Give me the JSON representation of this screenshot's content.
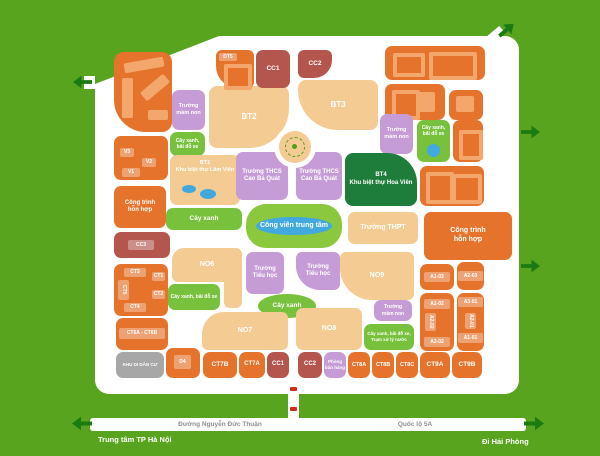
{
  "map": {
    "colors": {
      "background": "#58a41e",
      "road": "#ffffff",
      "residential": "#e5732b",
      "building": "#f3a76d",
      "villa_tan": "#f4cb92",
      "public": "#b4564e",
      "school": "#c59cd6",
      "green": "#77c13c",
      "park": "#8cc83e",
      "villa_green": "#1e7d3a",
      "gray": "#a7a7a7",
      "water": "#41a9de",
      "arrow": "#1c7a12",
      "road_text": "#8f8f8f"
    },
    "roads": {
      "west": "Đường Nguyễn Đức Thuận",
      "east": "Quốc lộ 5A"
    },
    "destinations": {
      "west": "Trung tâm TP Hà Nội",
      "east": "Đi Hải Phòng"
    },
    "blocks": [
      {
        "id": "residential-nw",
        "type": "res",
        "x": 114,
        "y": 52,
        "w": 58,
        "h": 80,
        "r": "10px 10px 10px 32px",
        "buildings": [
          {
            "x": 10,
            "y": 8,
            "w": 40,
            "h": 10,
            "rot": -10
          },
          {
            "x": 8,
            "y": 26,
            "w": 11,
            "h": 40
          },
          {
            "x": 26,
            "y": 30,
            "w": 30,
            "h": 11,
            "rot": -40
          },
          {
            "x": 34,
            "y": 58,
            "w": 20,
            "h": 10
          }
        ]
      },
      {
        "id": "residential-nw-v",
        "type": "res",
        "x": 114,
        "y": 136,
        "w": 54,
        "h": 44,
        "tags": [
          {
            "t": "V3",
            "x": 6,
            "y": 12,
            "w": 14,
            "h": 9
          },
          {
            "t": "V2",
            "x": 28,
            "y": 22,
            "w": 14,
            "h": 9
          },
          {
            "t": "V1",
            "x": 8,
            "y": 32,
            "w": 18,
            "h": 9
          }
        ]
      },
      {
        "id": "mixed-use-west",
        "type": "res",
        "x": 114,
        "y": 186,
        "w": 52,
        "h": 42,
        "label": "Công trình\nhỗn hợp",
        "fs": 6
      },
      {
        "id": "cc3",
        "type": "cc",
        "x": 114,
        "y": 232,
        "w": 56,
        "h": 26,
        "tags": [
          {
            "t": "CC3",
            "x": 14,
            "y": 8,
            "w": 26,
            "h": 10
          }
        ]
      },
      {
        "id": "ct-cluster",
        "type": "res",
        "x": 114,
        "y": 264,
        "w": 54,
        "h": 52,
        "tags": [
          {
            "t": "CT3",
            "x": 10,
            "y": 4,
            "w": 22,
            "h": 9
          },
          {
            "t": "CT1",
            "x": 38,
            "y": 8,
            "w": 13,
            "h": 9
          },
          {
            "t": "CT5",
            "x": 4,
            "y": 16,
            "w": 11,
            "h": 20,
            "v": 1
          },
          {
            "t": "CT2",
            "x": 38,
            "y": 26,
            "w": 13,
            "h": 9
          },
          {
            "t": "CT4",
            "x": 10,
            "y": 39,
            "w": 22,
            "h": 9
          }
        ]
      },
      {
        "id": "ct6ab",
        "type": "res",
        "x": 116,
        "y": 318,
        "w": 52,
        "h": 32,
        "tags": [
          {
            "t": "CT6A - CT6B",
            "x": 3,
            "y": 10,
            "w": 46,
            "h": 11
          }
        ]
      },
      {
        "id": "resettlement-area",
        "type": "gray",
        "x": 116,
        "y": 352,
        "w": 48,
        "h": 26,
        "label": "KHU DI DÂN CƯ",
        "fs": 4.5
      },
      {
        "id": "d4",
        "type": "res",
        "x": 166,
        "y": 348,
        "w": 34,
        "h": 30,
        "tags": [
          {
            "t": "D4",
            "x": 8,
            "y": 7,
            "w": 17,
            "h": 14
          }
        ]
      },
      {
        "id": "kindergarten-nw",
        "type": "school",
        "x": 172,
        "y": 90,
        "w": 33,
        "h": 40,
        "label": "Trường\nmầm non",
        "fs": 5.5
      },
      {
        "id": "parking-nw",
        "type": "green",
        "x": 170,
        "y": 132,
        "w": 35,
        "h": 24,
        "label": "Cây xanh,\nbãi đỗ xe",
        "fs": 5
      },
      {
        "id": "bt2",
        "type": "tan",
        "x": 209,
        "y": 86,
        "w": 80,
        "h": 62,
        "label": "BT2",
        "fs": 8,
        "r": "8px 8px 40px 8px"
      },
      {
        "id": "bt1-lam-vien",
        "type": "tan",
        "x": 170,
        "y": 155,
        "w": 70,
        "h": 50,
        "label": "BT1\nKhu biệt thự Lâm Viên",
        "fs": 5.5,
        "top": 1,
        "dots": [
          {
            "x": 12,
            "y": 30,
            "w": 14,
            "h": 8
          },
          {
            "x": 30,
            "y": 34,
            "w": 16,
            "h": 10
          }
        ]
      },
      {
        "id": "bt3",
        "type": "tan",
        "x": 298,
        "y": 80,
        "w": 80,
        "h": 50,
        "label": "BT3",
        "fs": 8,
        "r": "8px 8px 8px 40px"
      },
      {
        "id": "dt5",
        "type": "res",
        "x": 216,
        "y": 50,
        "w": 38,
        "h": 38,
        "r": "6px 6px 6px 22px",
        "tags": [
          {
            "t": "DT5",
            "x": 3,
            "y": 3,
            "w": 18,
            "h": 8
          }
        ],
        "buildings": [
          {
            "x": 8,
            "y": 14,
            "w": 20,
            "h": 18,
            "ring": 1
          }
        ]
      },
      {
        "id": "cc1-north",
        "type": "cc",
        "x": 256,
        "y": 50,
        "w": 34,
        "h": 38,
        "label": "CC1",
        "fs": 6.5
      },
      {
        "id": "cc2-north",
        "type": "cc",
        "x": 298,
        "y": 50,
        "w": 34,
        "h": 28,
        "label": "CC2",
        "fs": 6.5,
        "r": "6px 6px 18px 6px"
      },
      {
        "id": "residential-ne-1",
        "type": "res",
        "x": 385,
        "y": 46,
        "w": 100,
        "h": 34,
        "buildings": [
          {
            "x": 8,
            "y": 7,
            "w": 24,
            "h": 16,
            "ring": 1
          },
          {
            "x": 44,
            "y": 6,
            "w": 40,
            "h": 20,
            "ring": 1
          }
        ]
      },
      {
        "id": "residential-ne-2",
        "type": "res",
        "x": 385,
        "y": 84,
        "w": 60,
        "h": 36,
        "buildings": [
          {
            "x": 7,
            "y": 6,
            "w": 20,
            "h": 22,
            "ring": 1
          },
          {
            "x": 33,
            "y": 8,
            "w": 17,
            "h": 20
          }
        ]
      },
      {
        "id": "residential-ne-3",
        "type": "res",
        "x": 449,
        "y": 90,
        "w": 34,
        "h": 30,
        "buildings": [
          {
            "x": 7,
            "y": 6,
            "w": 18,
            "h": 16
          }
        ]
      },
      {
        "id": "kindergarten-ne",
        "type": "school",
        "x": 380,
        "y": 114,
        "w": 33,
        "h": 40,
        "label": "Trường\nmầm non",
        "fs": 5.5
      },
      {
        "id": "parking-ne",
        "type": "green",
        "x": 417,
        "y": 120,
        "w": 33,
        "h": 42,
        "label": "Cây xanh,\nbãi đỗ xe",
        "fs": 5,
        "top": 1,
        "dots": [
          {
            "x": 10,
            "y": 24,
            "w": 13,
            "h": 13
          }
        ]
      },
      {
        "id": "residential-e1",
        "type": "res",
        "x": 453,
        "y": 120,
        "w": 30,
        "h": 42,
        "buildings": [
          {
            "x": 6,
            "y": 10,
            "w": 16,
            "h": 22,
            "ring": 1
          }
        ]
      },
      {
        "id": "residential-e2",
        "type": "res",
        "x": 420,
        "y": 166,
        "w": 64,
        "h": 40,
        "buildings": [
          {
            "x": 6,
            "y": 6,
            "w": 20,
            "h": 24,
            "ring": 1
          },
          {
            "x": 32,
            "y": 8,
            "w": 22,
            "h": 22,
            "ring": 1
          }
        ]
      },
      {
        "id": "mixed-use-east",
        "type": "res",
        "x": 424,
        "y": 212,
        "w": 88,
        "h": 48,
        "label": "Công trình\nhỗn hợp",
        "fs": 7
      },
      {
        "id": "thcs-west",
        "type": "school",
        "x": 236,
        "y": 152,
        "w": 52,
        "h": 48,
        "label": "Trường THCS\nCao Bá Quát",
        "fs": 6
      },
      {
        "id": "thcs-east",
        "type": "school",
        "x": 296,
        "y": 152,
        "w": 46,
        "h": 48,
        "label": "Trường THCS\nCao Bá Quát",
        "fs": 6
      },
      {
        "id": "bt4-hoa-vien",
        "type": "dgreen",
        "x": 345,
        "y": 153,
        "w": 72,
        "h": 53,
        "label": "BT4\nKhu biệt thự Hoa Viên",
        "fs": 6,
        "r": "8px 30px 8px 8px"
      },
      {
        "id": "green-strip-west",
        "type": "green",
        "x": 166,
        "y": 208,
        "w": 76,
        "h": 22,
        "label": "Cây xanh",
        "fs": 6.5
      },
      {
        "id": "central-park",
        "type": "park",
        "x": 246,
        "y": 204,
        "w": 96,
        "h": 44,
        "label": "Công viên trung tâm",
        "fs": 7,
        "r": "20px",
        "dots": [
          {
            "x": 10,
            "y": 13,
            "w": 76,
            "h": 18
          }
        ]
      },
      {
        "id": "thpt",
        "type": "tan",
        "x": 348,
        "y": 212,
        "w": 70,
        "h": 32,
        "label": "Trường THPT",
        "fs": 7
      },
      {
        "id": "no6",
        "type": "tan",
        "x": 172,
        "y": 248,
        "w": 70,
        "h": 34,
        "label": "NO6",
        "fs": 7,
        "r": "12px 6px 6px 6px"
      },
      {
        "id": "no6-ext",
        "type": "tan",
        "x": 224,
        "y": 250,
        "w": 18,
        "h": 58,
        "r": "6px"
      },
      {
        "id": "parking-center",
        "type": "green",
        "x": 168,
        "y": 284,
        "w": 52,
        "h": 26,
        "label": "Cây xanh, bãi đỗ xe",
        "fs": 5
      },
      {
        "id": "primary-school-west",
        "type": "school",
        "x": 246,
        "y": 252,
        "w": 38,
        "h": 42,
        "label": "Trường\nTiểu học",
        "fs": 6
      },
      {
        "id": "primary-school-east",
        "type": "school",
        "x": 296,
        "y": 252,
        "w": 44,
        "h": 38,
        "label": "Trường\nTiểu học",
        "fs": 6,
        "r": "6px 6px 6px 24px"
      },
      {
        "id": "green-oval",
        "type": "green",
        "x": 258,
        "y": 294,
        "w": 58,
        "h": 24,
        "label": "Cây xanh",
        "fs": 6.5,
        "r": "50%"
      },
      {
        "id": "no7",
        "type": "tan",
        "x": 202,
        "y": 312,
        "w": 86,
        "h": 38,
        "label": "NO7",
        "fs": 7,
        "r": "22px 6px 6px 6px"
      },
      {
        "id": "no9",
        "type": "tan",
        "x": 340,
        "y": 252,
        "w": 74,
        "h": 48,
        "label": "NO9",
        "fs": 7,
        "r": "6px 6px 6px 32px"
      },
      {
        "id": "no8",
        "type": "tan",
        "x": 296,
        "y": 308,
        "w": 66,
        "h": 42,
        "label": "NO8",
        "fs": 7
      },
      {
        "id": "kindergarten-se",
        "type": "school",
        "x": 374,
        "y": 300,
        "w": 38,
        "h": 21,
        "label": "Trường\nmầm non",
        "fs": 5
      },
      {
        "id": "parking-se",
        "type": "green",
        "x": 364,
        "y": 324,
        "w": 50,
        "h": 26,
        "label": "Cây xanh, bãi đỗ xe,\nTrạm xử lý nước",
        "fs": 4.5
      },
      {
        "id": "a1-03-block",
        "type": "res",
        "x": 420,
        "y": 264,
        "w": 34,
        "h": 26,
        "tags": [
          {
            "t": "A1-03",
            "x": 4,
            "y": 8,
            "w": 26,
            "h": 10
          }
        ]
      },
      {
        "id": "a2-03-block",
        "type": "res",
        "x": 457,
        "y": 262,
        "w": 27,
        "h": 28,
        "tags": [
          {
            "t": "A2-03",
            "x": 1,
            "y": 9,
            "w": 25,
            "h": 10
          }
        ]
      },
      {
        "id": "a-west-block",
        "type": "res",
        "x": 420,
        "y": 293,
        "w": 34,
        "h": 58,
        "tags": [
          {
            "t": "A1-02",
            "x": 4,
            "y": 6,
            "w": 26,
            "h": 10
          },
          {
            "t": "A2-02",
            "x": 5,
            "y": 20,
            "w": 11,
            "h": 18,
            "v": 1
          },
          {
            "t": "A3-02",
            "x": 4,
            "y": 44,
            "w": 26,
            "h": 10
          }
        ]
      },
      {
        "id": "a-east-block",
        "type": "res",
        "x": 457,
        "y": 293,
        "w": 27,
        "h": 58,
        "tags": [
          {
            "t": "A3-01",
            "x": 1,
            "y": 4,
            "w": 25,
            "h": 10
          },
          {
            "t": "A2-01",
            "x": 8,
            "y": 20,
            "w": 11,
            "h": 16,
            "v": 1
          },
          {
            "t": "A1-01",
            "x": 1,
            "y": 40,
            "w": 25,
            "h": 10
          }
        ]
      },
      {
        "id": "ct7b",
        "type": "res",
        "x": 203,
        "y": 352,
        "w": 34,
        "h": 26,
        "label": "CT7B",
        "fs": 6.5
      },
      {
        "id": "ct7a",
        "type": "res",
        "x": 239,
        "y": 352,
        "w": 26,
        "h": 26,
        "label": "CT7A",
        "fs": 6
      },
      {
        "id": "cc1-south",
        "type": "cc",
        "x": 267,
        "y": 352,
        "w": 22,
        "h": 26,
        "label": "CC1",
        "fs": 6
      },
      {
        "id": "cc2-south",
        "type": "cc",
        "x": 298,
        "y": 352,
        "w": 24,
        "h": 26,
        "label": "CC2",
        "fs": 6
      },
      {
        "id": "sales-office",
        "type": "school",
        "x": 324,
        "y": 352,
        "w": 22,
        "h": 26,
        "label": "Phòng\nbán hàng",
        "fs": 4.5
      },
      {
        "id": "ct8a",
        "type": "res",
        "x": 348,
        "y": 352,
        "w": 22,
        "h": 26,
        "label": "CT8A",
        "fs": 5.5
      },
      {
        "id": "ct8b",
        "type": "res",
        "x": 372,
        "y": 352,
        "w": 22,
        "h": 26,
        "label": "CT8B",
        "fs": 5.5
      },
      {
        "id": "ct8c",
        "type": "res",
        "x": 396,
        "y": 352,
        "w": 22,
        "h": 26,
        "label": "CT8C",
        "fs": 5.5
      },
      {
        "id": "ct9a",
        "type": "res",
        "x": 420,
        "y": 352,
        "w": 30,
        "h": 26,
        "label": "CT9A",
        "fs": 6.5
      },
      {
        "id": "ct9b",
        "type": "res",
        "x": 452,
        "y": 352,
        "w": 30,
        "h": 26,
        "label": "CT9B",
        "fs": 6.5
      }
    ]
  }
}
